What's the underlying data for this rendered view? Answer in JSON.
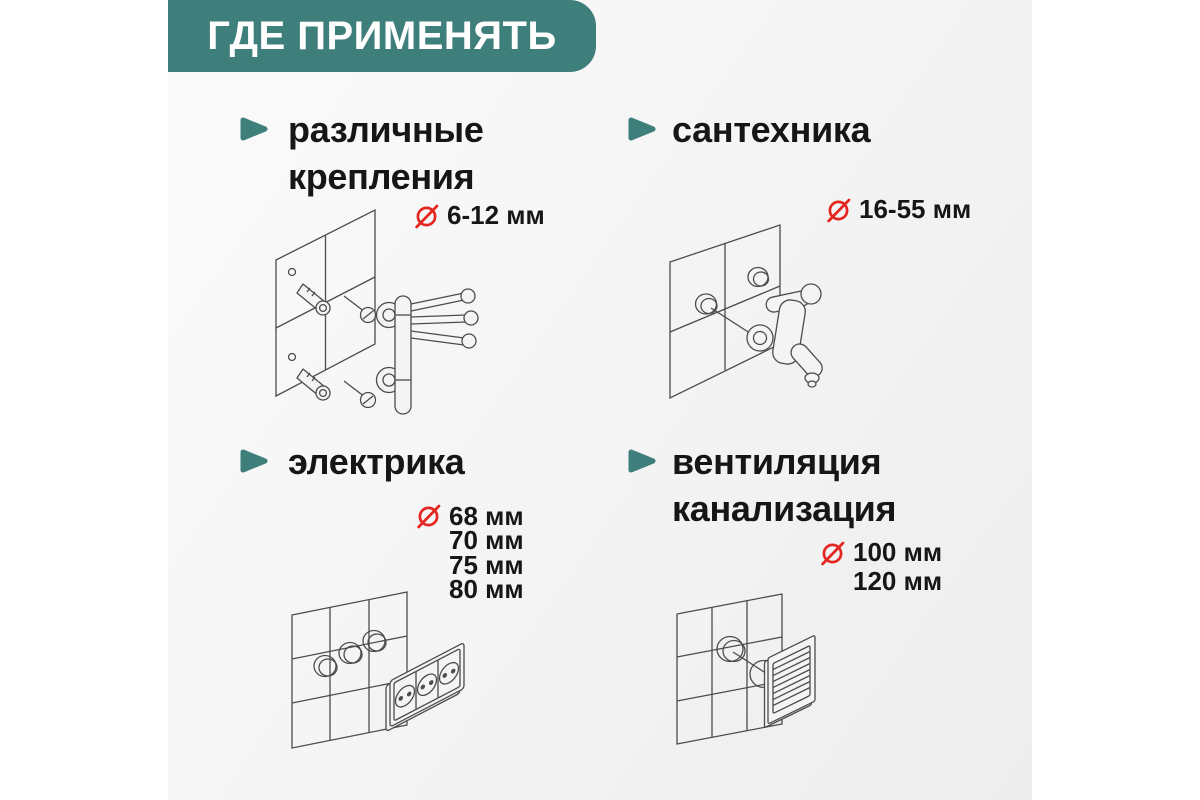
{
  "header": {
    "title": "ГДЕ ПРИМЕНЯТЬ"
  },
  "accent": {
    "teal": "#3E7E7B",
    "red": "#E42620",
    "ink": "#161616"
  },
  "icons": {
    "bullet": "right-arrow-icon",
    "diameter": "diameter-slashed-circle-icon"
  },
  "sections": [
    {
      "id": "fasteners",
      "lines": [
        "различные",
        "крепления"
      ],
      "diameters": [
        "6-12 мм"
      ],
      "illustration": "towel-rail-anchors-on-tiled-wall"
    },
    {
      "id": "plumbing",
      "lines": [
        "сантехника"
      ],
      "diameters": [
        "16-55 мм"
      ],
      "illustration": "wall-faucet-on-tiled-wall"
    },
    {
      "id": "electrics",
      "lines": [
        "электрика"
      ],
      "diameters": [
        "68 мм",
        "70 мм",
        "75 мм",
        "80 мм"
      ],
      "illustration": "triple-socket-holes-on-tiled-wall"
    },
    {
      "id": "ventilation",
      "lines": [
        "вентиляция",
        "канализация"
      ],
      "diameters": [
        "100 мм",
        "120 мм"
      ],
      "illustration": "vent-grille-hole-on-tiled-wall"
    }
  ]
}
